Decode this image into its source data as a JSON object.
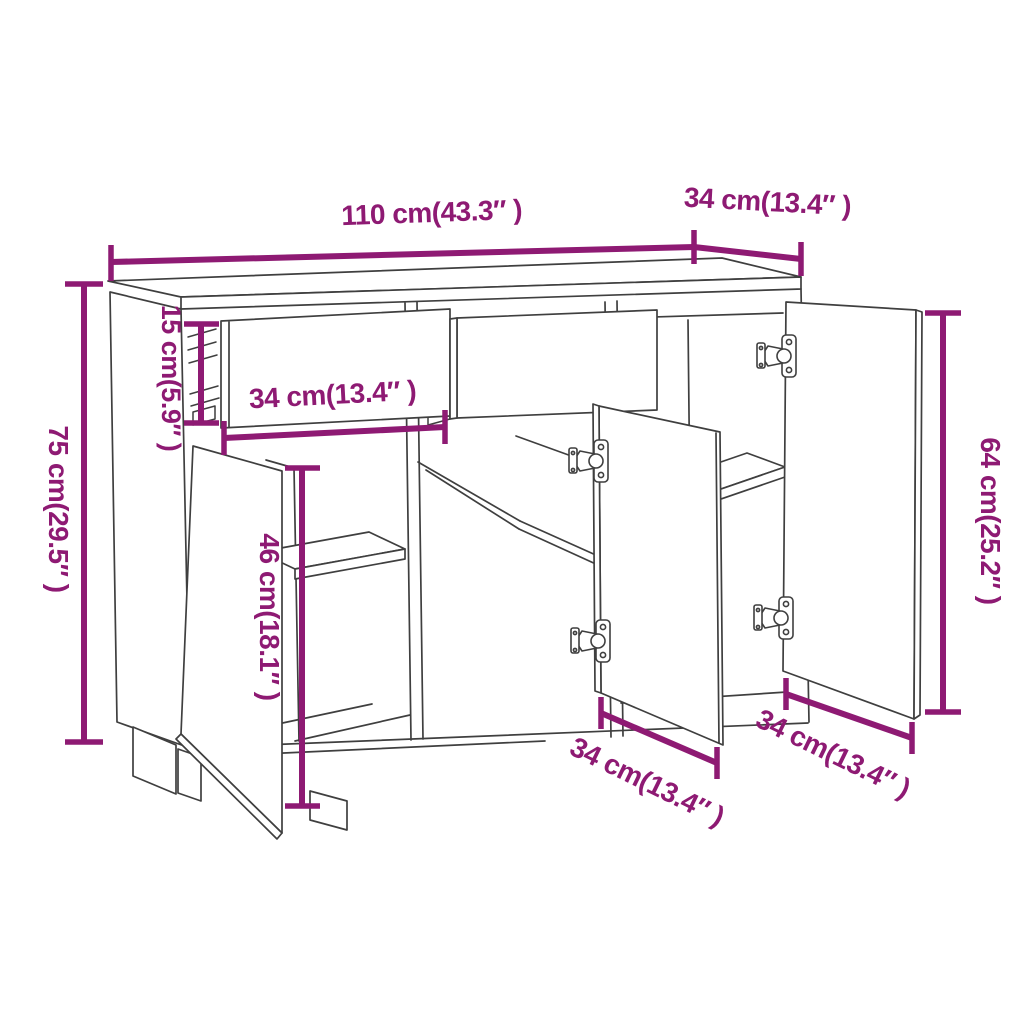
{
  "page": {
    "background": "#FFFFFF"
  },
  "diagram": {
    "type": "furniture-dimension-diagram",
    "product": "sideboard with three doors and two open drawers",
    "line_color": "#3F3F3F",
    "dimension_color": "#8E1A73",
    "measurements": [
      {
        "id": "overall-width",
        "cm": "110",
        "inches": "43.3",
        "label": "110 cm(43.3″ )"
      },
      {
        "id": "overall-depth",
        "cm": "34",
        "inches": "13.4",
        "label": "34 cm(13.4″ )"
      },
      {
        "id": "overall-height",
        "cm": "75",
        "inches": "29.5",
        "label": "75 cm(29.5″ )"
      },
      {
        "id": "drawer-height",
        "cm": "15",
        "inches": "5.9",
        "label": "15 cm(5.9″ )"
      },
      {
        "id": "drawer-width",
        "cm": "34",
        "inches": "13.4",
        "label": "34 cm(13.4″ )"
      },
      {
        "id": "interior-height",
        "cm": "46",
        "inches": "18.1",
        "label": "46 cm(18.1″ )"
      },
      {
        "id": "door-height",
        "cm": "64",
        "inches": "25.2",
        "label": "64 cm(25.2″ )"
      },
      {
        "id": "middle-door-width",
        "cm": "34",
        "inches": "13.4",
        "label": "34 cm(13.4″ )"
      },
      {
        "id": "right-door-width",
        "cm": "34",
        "inches": "13.4",
        "label": "34 cm(13.4″ )"
      }
    ]
  }
}
